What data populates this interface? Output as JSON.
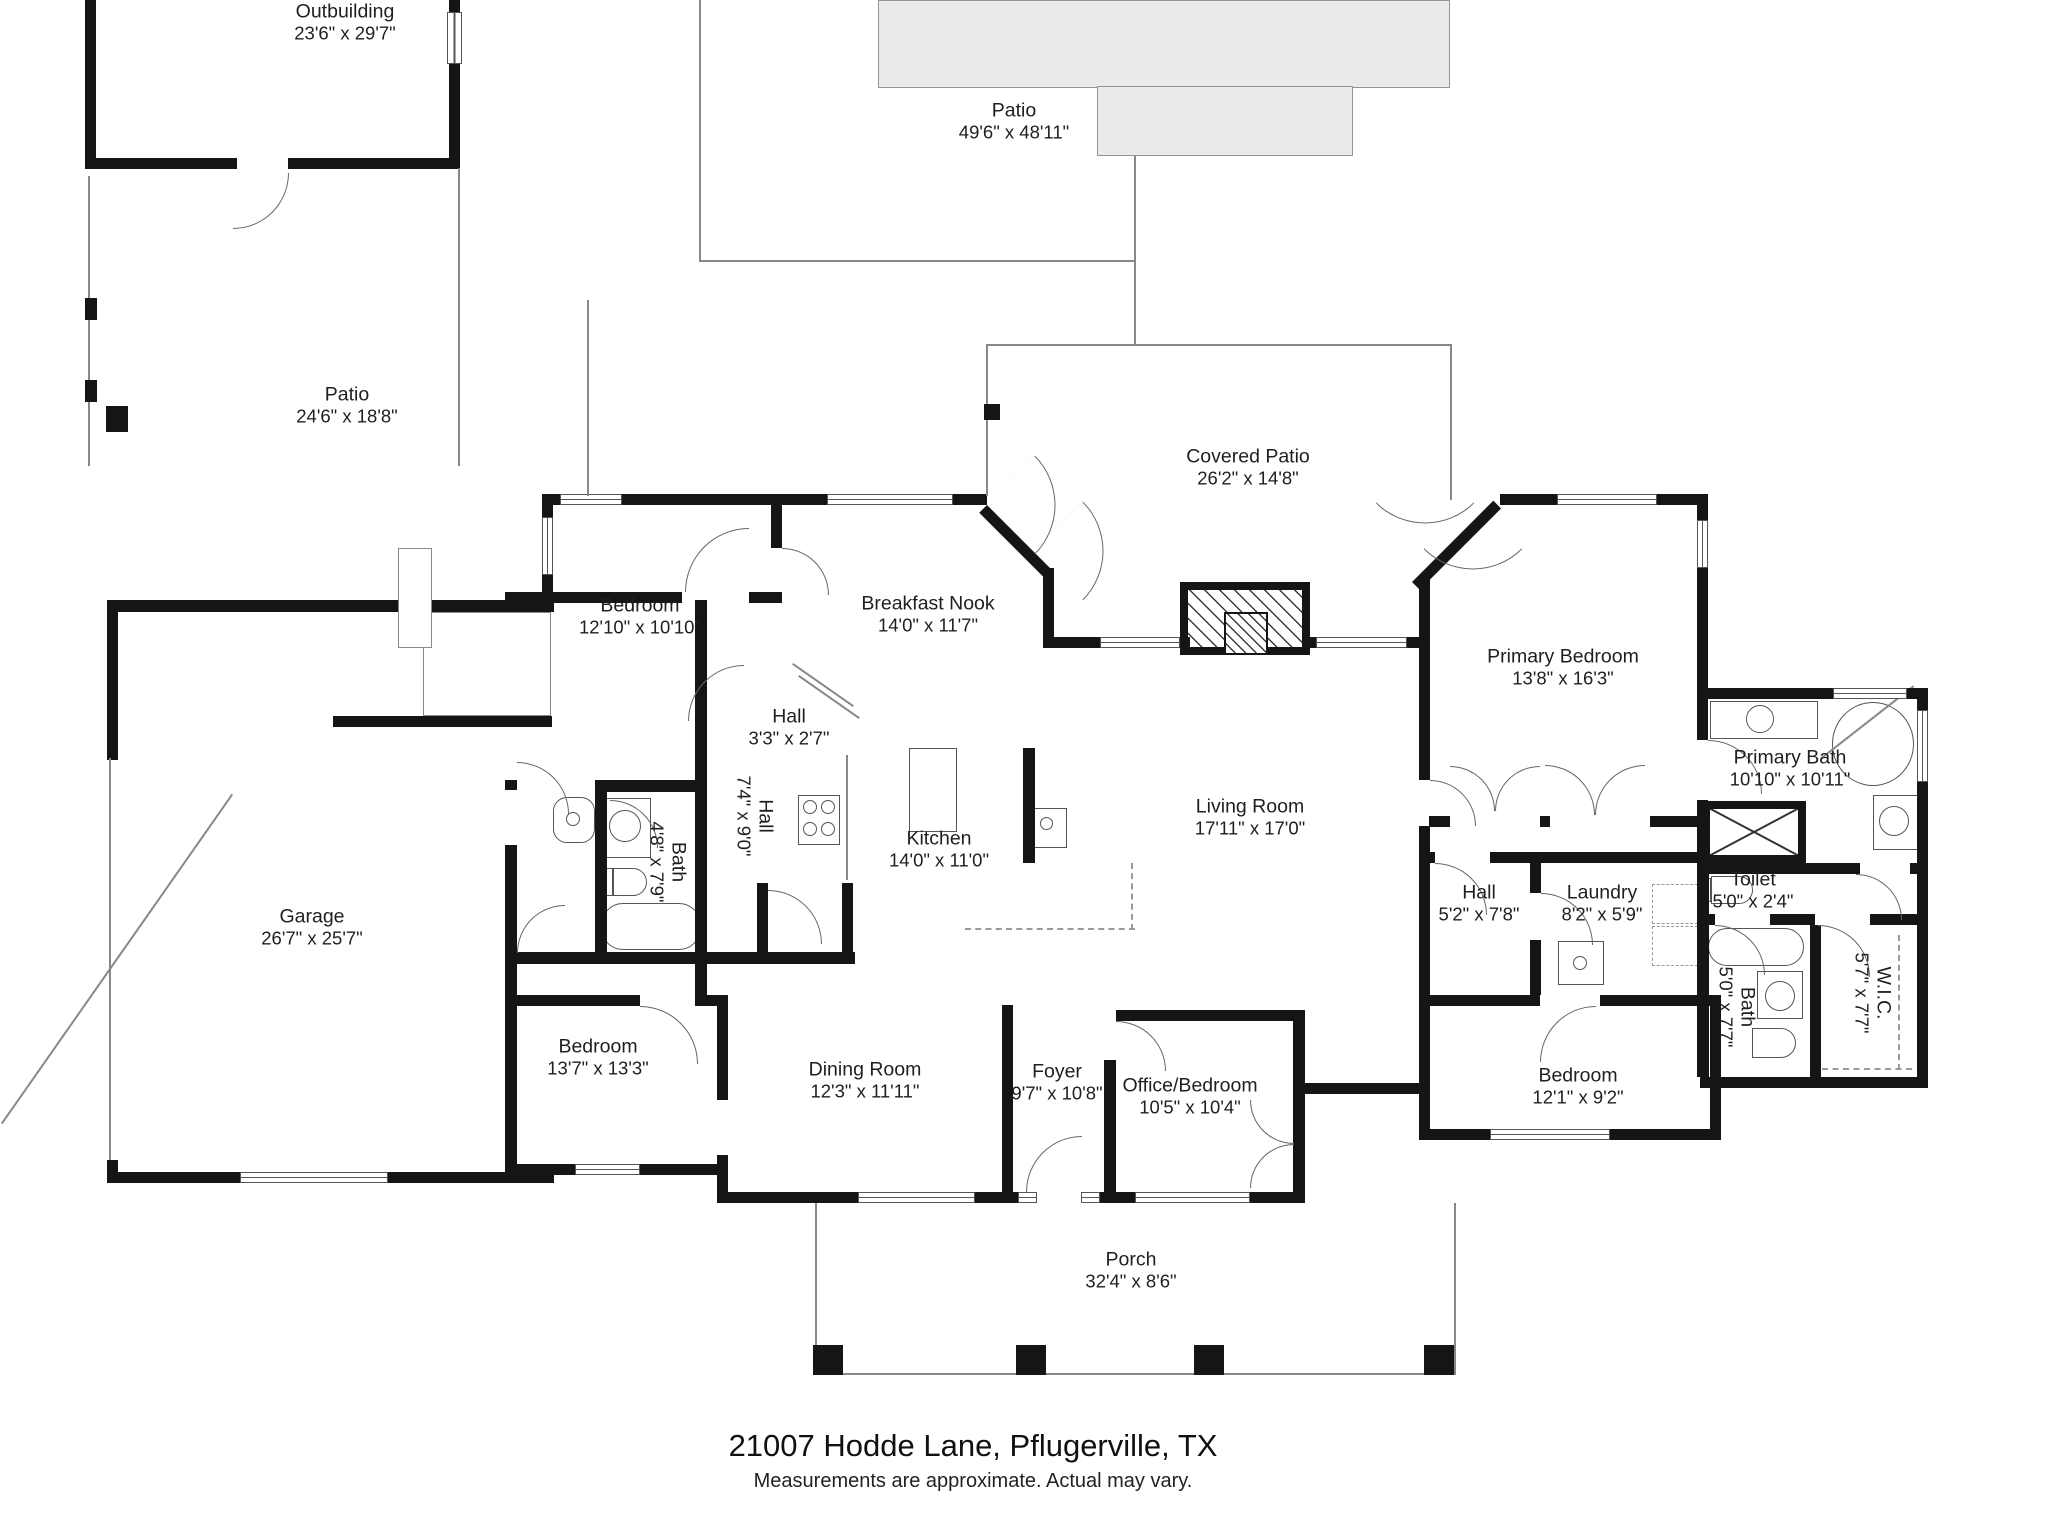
{
  "footer": {
    "address": "21007 Hodde Lane, Pflugerville, TX",
    "disclaimer": "Measurements are approximate.  Actual may vary."
  },
  "colors": {
    "wall": "#151515",
    "patio_fill": "#e9eaea",
    "thin_line": "#888888",
    "text": "#1f1f1f"
  },
  "rooms": [
    {
      "name": "Outbuilding",
      "dims": "23'6\" x 29'7\""
    },
    {
      "name": "Patio",
      "dims": "49'6\" x 48'11\""
    },
    {
      "name": "Patio",
      "dims": "24'6\" x 18'8\""
    },
    {
      "name": "Covered Patio",
      "dims": "26'2\" x 14'8\""
    },
    {
      "name": "Bedroom",
      "dims": "12'10\" x 10'10\""
    },
    {
      "name": "Breakfast Nook",
      "dims": "14'0\" x 11'7\""
    },
    {
      "name": "Primary Bedroom",
      "dims": "13'8\" x 16'3\""
    },
    {
      "name": "Primary Bath",
      "dims": "10'10\" x 10'11\""
    },
    {
      "name": "Hall",
      "dims": "3'3\" x 2'7\""
    },
    {
      "name": "Hall",
      "dims": "7'4\" x 9'0\""
    },
    {
      "name": "Bath",
      "dims": "4'8\" x 7'9\""
    },
    {
      "name": "Kitchen",
      "dims": "14'0\" x 11'0\""
    },
    {
      "name": "Living Room",
      "dims": "17'11\" x 17'0\""
    },
    {
      "name": "Garage",
      "dims": "26'7\" x 25'7\""
    },
    {
      "name": "Hall",
      "dims": "5'2\" x 7'8\""
    },
    {
      "name": "Laundry",
      "dims": "8'2\" x 5'9\""
    },
    {
      "name": "Toilet",
      "dims": "5'0\" x 2'4\""
    },
    {
      "name": "Bath",
      "dims": "5'0\" x 7'7\""
    },
    {
      "name": "W.I.C.",
      "dims": "5'7\" x 7'7\""
    },
    {
      "name": "Bedroom",
      "dims": "12'1\" x 9'2\""
    },
    {
      "name": "Bedroom",
      "dims": "13'7\" x 13'3\""
    },
    {
      "name": "Dining Room",
      "dims": "12'3\" x 11'11\""
    },
    {
      "name": "Foyer",
      "dims": "9'7\" x 10'8\""
    },
    {
      "name": "Office/Bedroom",
      "dims": "10'5\" x 10'4\""
    },
    {
      "name": "Porch",
      "dims": "32'4\" x 8'6\""
    }
  ],
  "fixture_icons": [
    "fireplace-icon",
    "stove-icon",
    "kitchen-island-icon",
    "sink-icon",
    "bathtub-icon",
    "corner-tub-icon",
    "toilet-icon",
    "shower-icon",
    "washer-dryer-icon",
    "water-heater-icon",
    "door-swing-icon",
    "window-icon",
    "porch-post-icon"
  ]
}
